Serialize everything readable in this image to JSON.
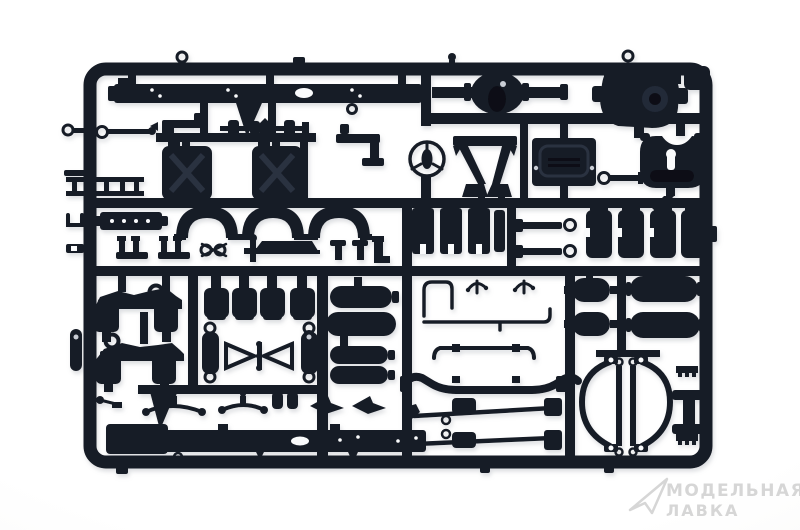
{
  "scene": {
    "description": "Photograph of a black injection-molded styrene sprue (model kit parts tree) with truck chassis parts on a white background",
    "background_color": "#ffffff",
    "plastic_color": "#171c27",
    "plastic_highlight": "#232a38",
    "plastic_shadow": "#0d1119"
  },
  "watermark": {
    "logo": "paper-plane-icon",
    "line1": "МОДЕЛЬНАЯ",
    "line2": "ЛАВКА",
    "color": "#d6d6d6"
  },
  "parts": [
    "sprue-frame",
    "runner-grid",
    "chassis-side-rail-top",
    "rear-axle-housing-left",
    "rear-axle-housing-right",
    "steering-wheel",
    "cab-mount-frame",
    "battery-box",
    "crank-handle",
    "fifth-wheel-coupling",
    "jerry-can-left",
    "jerry-can-right",
    "ladder-frame",
    "tow-bar",
    "pistol-bracket",
    "drive-shaft",
    "wheel-arch-1",
    "wheel-arch-2",
    "wheel-arch-3",
    "bumper-grille",
    "fork-bracket-1",
    "fork-bracket-2",
    "linkage-glasses",
    "cross-pin",
    "step-plate",
    "t-post-1",
    "t-post-2",
    "gun-bracket",
    "leaf-spring-slabs",
    "towing-pin-1",
    "towing-pin-2",
    "brake-chambers",
    "axle-drum-assembly-1",
    "axle-drum-assembly-2",
    "engine-mounts",
    "shock-absorber-left",
    "shock-absorber-right",
    "wishbone-linkage",
    "muffler-tanks",
    "air-capsule",
    "brake-lines",
    "stabilizer-pipe",
    "front-axle-beam",
    "tie-rod-1",
    "tie-rod-2",
    "fender-arch-left",
    "fender-arch-right",
    "h-bracket",
    "chassis-side-rail-bottom",
    "gusset-triangle",
    "steering-link-1",
    "steering-link-2",
    "small-cylinders",
    "wing-bracket-1",
    "wing-bracket-2",
    "air-tank-oval-1",
    "air-tank-oval-2",
    "air-tank-long-1",
    "air-tank-long-2",
    "sprue-gate-nubs"
  ]
}
